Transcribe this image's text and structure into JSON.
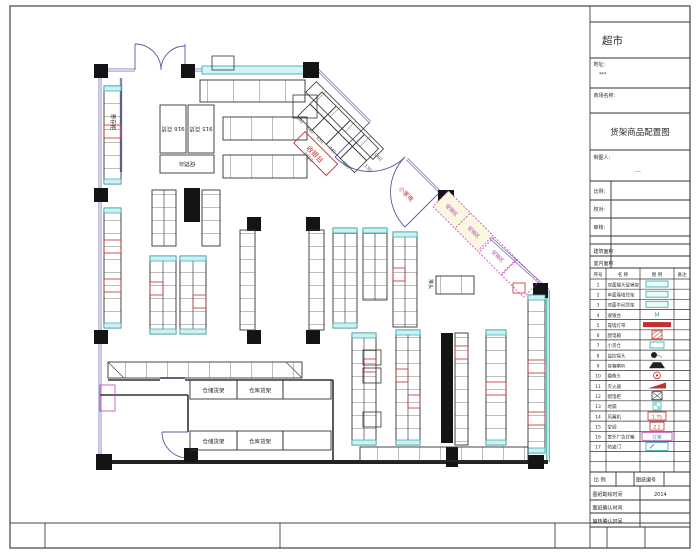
{
  "title_block": {
    "project_name": "超市",
    "address_label": "地址:",
    "address_value": "***",
    "store_label": "商场名称:",
    "drawing_title": "货架商品配置图",
    "drafter_label": "制图人:",
    "drafter_value": "...",
    "scale_label": "比例:",
    "proof_label": "校对:",
    "review_label": "审核:",
    "building_area_label": "建筑面积",
    "indoor_area_label": "室内面积",
    "scale2_label": "比 例",
    "drawing_no_label": "图纸编号",
    "survey_label": "图纸勘绘时间",
    "survey_value": "2014",
    "confirm_label": "图纸确认时间",
    "review_confirm_label": "审核确认时间"
  },
  "legend": {
    "headers": [
      "序号",
      "名 称",
      "图 例",
      "备注"
    ],
    "rows": [
      {
        "no": "1",
        "name": "双面端头促销架",
        "sym": ""
      },
      {
        "no": "2",
        "name": "单面靠墙货架",
        "sym": ""
      },
      {
        "no": "3",
        "name": "双面中间货架",
        "sym": ""
      },
      {
        "no": "4",
        "name": "收银台",
        "sym": "M"
      },
      {
        "no": "5",
        "name": "靠墙灯带",
        "sym": ""
      },
      {
        "no": "6",
        "name": "配电箱",
        "sym": ""
      },
      {
        "no": "7",
        "name": "小货仓",
        "sym": ""
      },
      {
        "no": "8",
        "name": "监控探头",
        "sym": ""
      },
      {
        "no": "9",
        "name": "音箱喇叭",
        "sym": ""
      },
      {
        "no": "10",
        "name": "摄像头",
        "sym": ""
      },
      {
        "no": "11",
        "name": "灭火器",
        "sym": ""
      },
      {
        "no": "12",
        "name": "配电柜",
        "sym": ""
      },
      {
        "no": "13",
        "name": "地漏",
        "sym": ""
      },
      {
        "no": "14",
        "name": "风幕机",
        "sym": "1.75"
      },
      {
        "no": "15",
        "name": "空调",
        "sym": "2.2"
      },
      {
        "no": "16",
        "name": "室外广告灯箱",
        "sym": "灯箱"
      },
      {
        "no": "17",
        "name": "防盗门",
        "sym": ""
      }
    ]
  },
  "plan": {
    "labels": {
      "cashier": "收银台",
      "appliances": "小家电",
      "locker": "寄存柜",
      "block_916": "916 百货",
      "block_915": "915 百货",
      "promo_table": "促销台",
      "pile_head": "堆头",
      "storage_a": "仓储货架",
      "storage_b": "仓库货架",
      "booth": "促销区"
    },
    "dims": [
      "640",
      "640",
      "650",
      "740",
      "3450",
      "650",
      "130",
      "1060"
    ]
  }
}
